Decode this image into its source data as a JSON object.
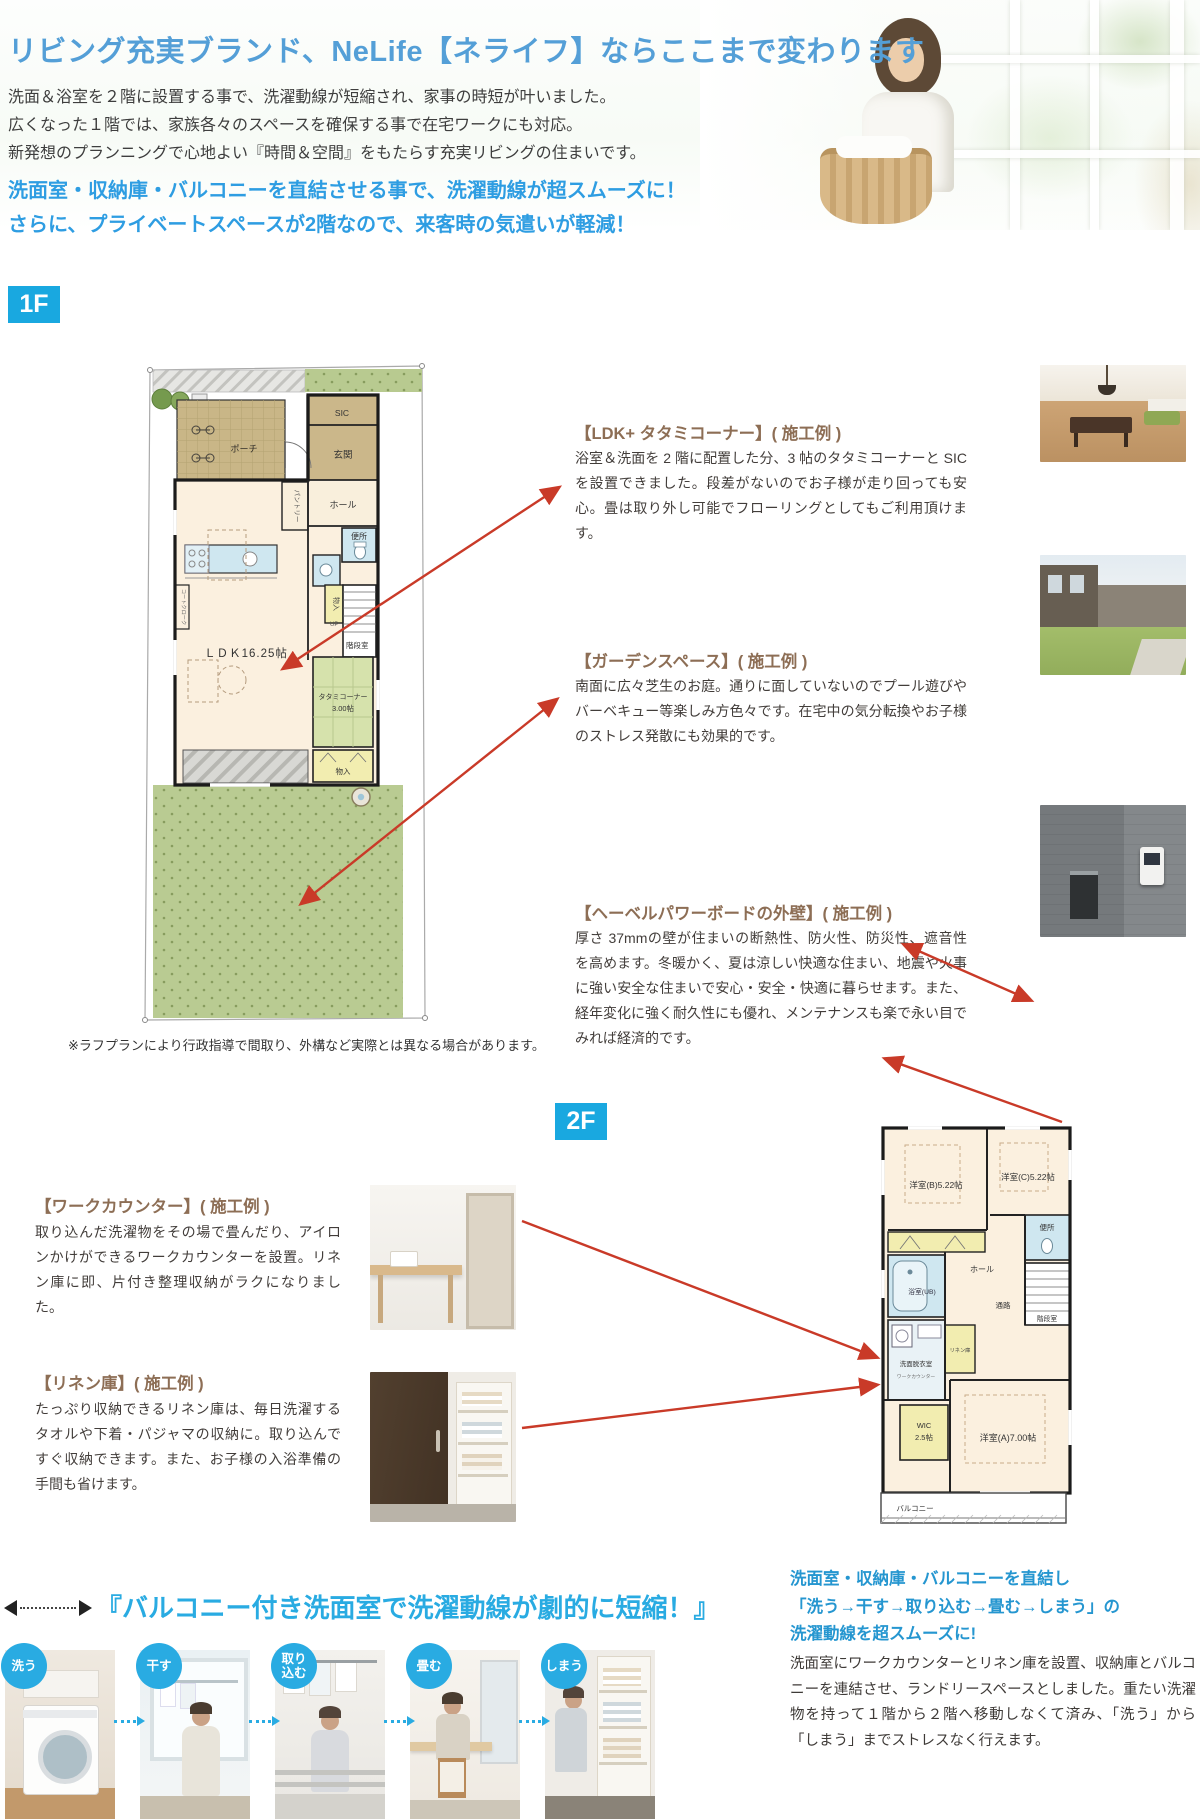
{
  "colors": {
    "accent_blue": "#29abe2",
    "title_blue": "#549fd7",
    "highlight_blue": "#2e9de2",
    "heading_brown": "#8d6e55",
    "arrow_red": "#c93a28"
  },
  "header": {
    "title": "リビング充実ブランド、NeLife【ネライフ】ならここまで変わります",
    "body": [
      "洗面＆浴室を２階に設置する事で、洗濯動線が短縮され、家事の時短が叶いました。",
      "広くなった１階では、家族各々のスペースを確保する事で在宅ワークにも対応。",
      "新発想のプランニングで心地よい『時間＆空間』をもたらす充実リビングの住まいです。"
    ],
    "highlights": [
      "洗面室・収納庫・バルコニーを直結させる事で、洗濯動線が超スムーズに！",
      "さらに、プライベートスペースが2階なので、来客時の気遣いが軽減！"
    ]
  },
  "floor1": {
    "badge": "1F",
    "disclaimer": "※ラフプランにより行政指導で間取り、外構など実際とは異なる場合があります。",
    "rooms": {
      "porch": "ポーチ",
      "sic": "SIC",
      "entrance": "玄関",
      "hall": "ホール",
      "pantry": "パントリー",
      "toilet": "便所",
      "storage1": "物入",
      "stairs": "階段室",
      "up": "UP",
      "coat": "コートクローク",
      "ldk": "ＬＤＫ16.25帖",
      "tatami_name": "タタミコーナー",
      "tatami_size": "3.00帖",
      "storage2": "物入"
    }
  },
  "features": [
    {
      "heading": "【LDK+ タタミコーナー】( 施工例 )",
      "body": "浴室＆洗面を 2 階に配置した分、3 帖のタタミコーナーと SIC を設置できました。段差がないのでお子様が走り回っても安心。畳は取り外し可能でフローリングとしてもご利用頂けます。"
    },
    {
      "heading": "【ガーデンスペース】( 施工例 )",
      "body": "南面に広々芝生のお庭。通りに面していないのでプール遊びやバーベキュー等楽しみ方色々です。在宅中の気分転換やお子様のストレス発散にも効果的です。"
    },
    {
      "heading": "【ヘーベルパワーボードの外壁】( 施工例 )",
      "body": "厚さ 37mmの壁が住まいの断熱性、防火性、防災性、遮音性を高めます。冬暖かく、夏は涼しい快適な住まい、地震や火事に強い安全な住まいで安心・安全・快適に暮らせます。また、経年変化に強く耐久性にも優れ、メンテナンスも楽で永い目でみれば経済的です。"
    },
    {
      "heading": "【ワークカウンター】( 施工例 )",
      "body": "取り込んだ洗濯物をその場で畳んだり、アイロンかけができるワークカウンターを設置。リネン庫に即、片付き整理収納がラクになりました。"
    },
    {
      "heading": "【リネン庫】( 施工例 )",
      "body": "たっぷり収納できるリネン庫は、毎日洗濯するタオルや下着・パジャマの収納に。取り込んですぐ収納できます。また、お子様の入浴準備の手間も省けます。"
    }
  ],
  "floor2": {
    "badge": "2F",
    "rooms": {
      "room_b": "洋室(B)5.22帖",
      "room_c": "洋室(C)5.22帖",
      "bath": "浴室(UB)",
      "washroom": "洗面脱衣室",
      "work_counter": "ワークカウンター",
      "linen": "リネン庫",
      "hall": "ホール",
      "toilet": "便所",
      "stairs": "階段室",
      "passage": "通路",
      "wic_name": "WIC",
      "wic_size": "2.5帖",
      "room_a": "洋室(A)7.00帖",
      "balcony": "バルコニー"
    }
  },
  "bottom": {
    "title": "『バルコニー付き洗面室で洗濯動線が劇的に短縮！』",
    "lead": [
      "洗面室・収納庫・バルコニーを直結し",
      "「洗う→干す→取り込む→畳む→しまう」の",
      "洗濯動線を超スムーズに!"
    ],
    "body": "洗面室にワークカウンターとリネン庫を設置、収納庫とバルコニーを連結させ、ランドリースペースとしました。重たい洗濯物を持って１階から２階へ移動しなくて済み、「洗う」から「しまう」までストレスなく行えます。",
    "steps": [
      {
        "label": "洗う"
      },
      {
        "label": "干す"
      },
      {
        "label": "取り\n込む"
      },
      {
        "label": "畳む"
      },
      {
        "label": "しまう"
      }
    ]
  }
}
